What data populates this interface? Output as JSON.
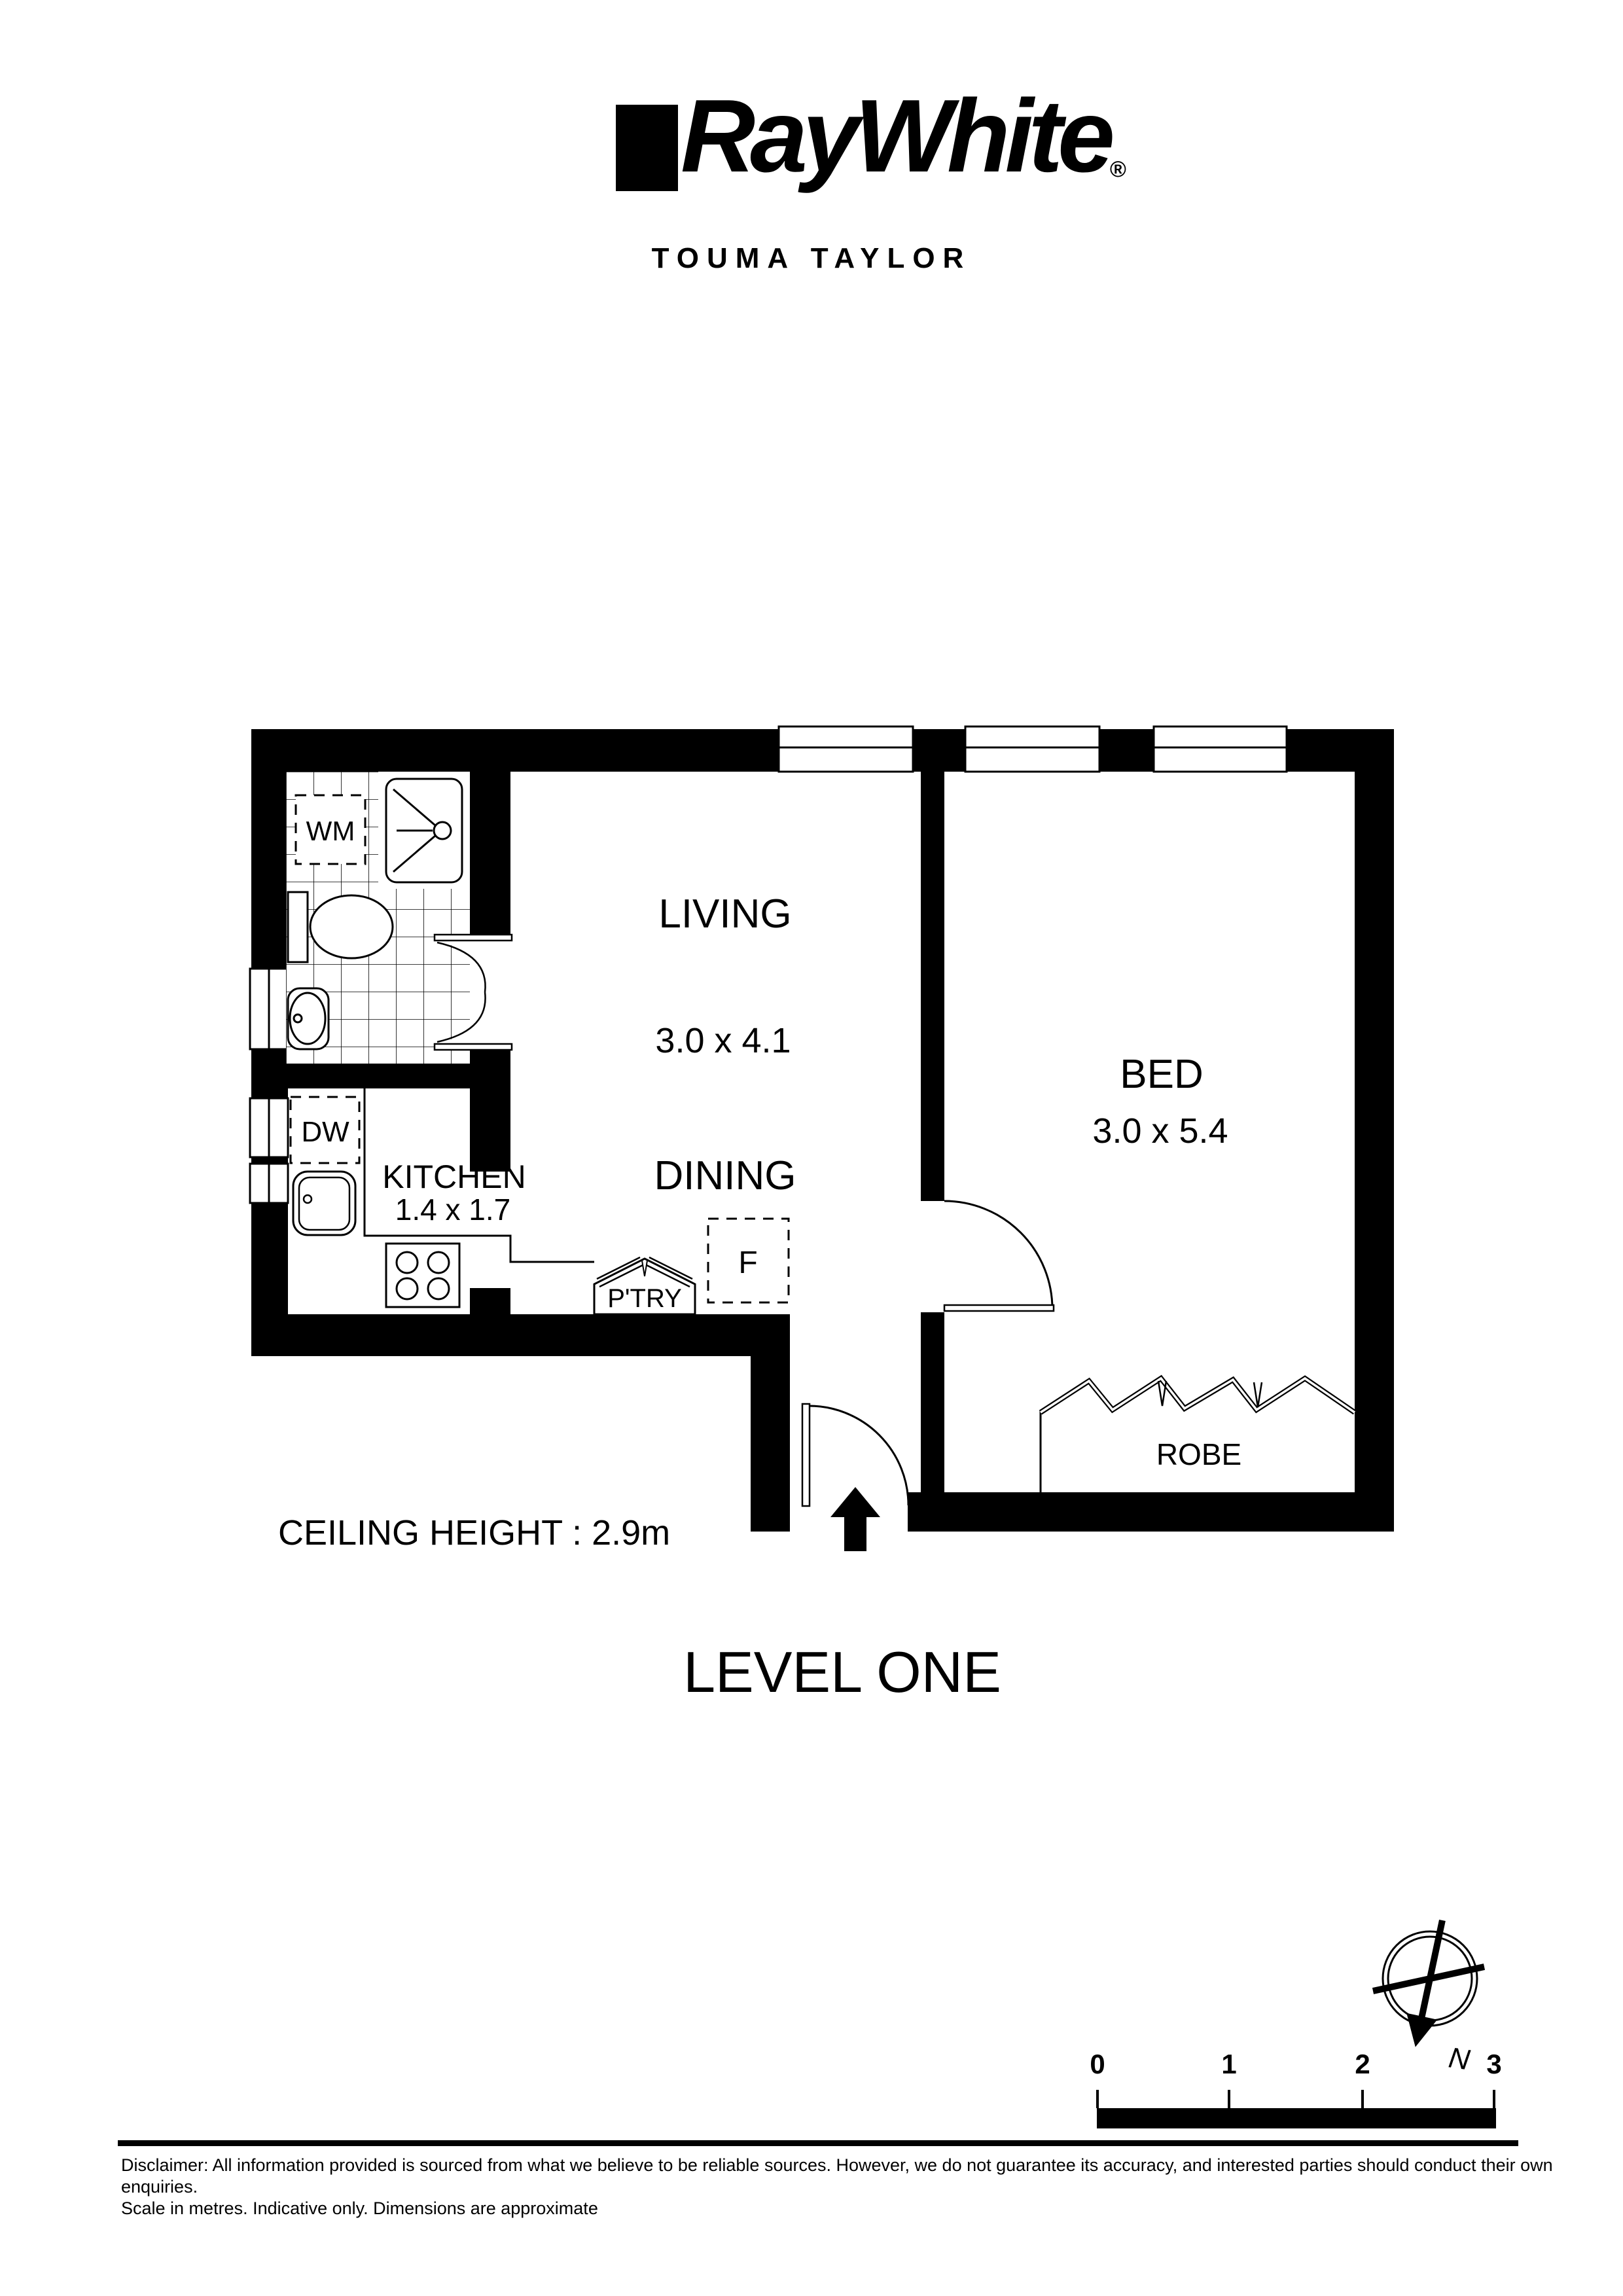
{
  "header": {
    "brand": "RayWhite",
    "registered": "®",
    "office": "TOUMA TAYLOR"
  },
  "plan": {
    "living": {
      "name": "LIVING",
      "dims": "3.0 x 4.1"
    },
    "dining": {
      "name": "DINING"
    },
    "bed": {
      "name": "BED",
      "dims": "3.0 x 5.4"
    },
    "kitchen": {
      "name": "KITCHEN",
      "dims": "1.4 x 1.7"
    },
    "fixtures": {
      "washing_machine": "WM",
      "dishwasher": "DW",
      "pantry": "P'TRY",
      "fridge": "F",
      "robe": "ROBE"
    },
    "ceiling_note": "CEILING HEIGHT : 2.9m"
  },
  "level_title": "LEVEL ONE",
  "compass": {
    "north": "N"
  },
  "scale_bar": {
    "ticks": [
      "0",
      "1",
      "2",
      "3"
    ]
  },
  "disclaimer": {
    "line1": "Disclaimer: All information provided is sourced from what we believe to be reliable sources. However, we do not guarantee  its accuracy, and interested parties should conduct their own enquiries.",
    "line2": "Scale in metres. Indicative only. Dimensions are approximate"
  }
}
